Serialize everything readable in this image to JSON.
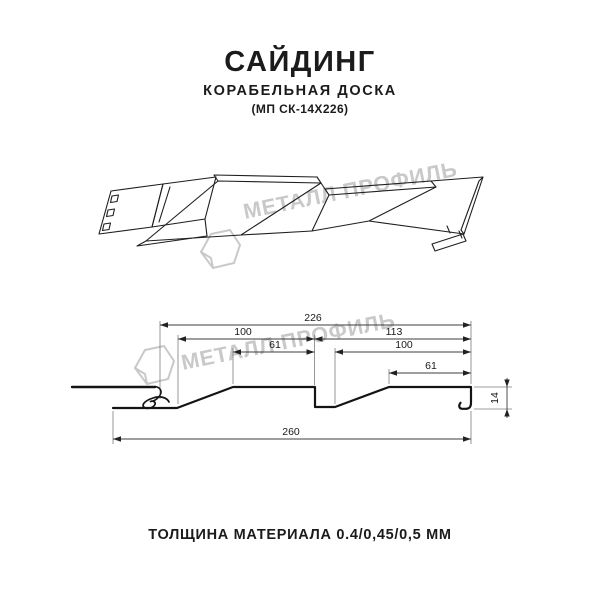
{
  "header": {
    "title": "САЙДИНГ",
    "subtitle": "КОРАБЕЛЬНАЯ ДОСКА",
    "code": "(МП СК-14Х226)"
  },
  "watermark": {
    "text": "МЕТАЛЛ ПРОФИЛЬ",
    "color": "#c9c9c9"
  },
  "dims": {
    "total": "226",
    "w100_left": "100",
    "w113": "113",
    "w61_left": "61",
    "w100_right": "100",
    "w61_right": "61",
    "overall": "260",
    "height": "14"
  },
  "footer": {
    "note": "ТОЛЩИНА МАТЕРИАЛА 0.4/0,45/0,5 ММ"
  }
}
